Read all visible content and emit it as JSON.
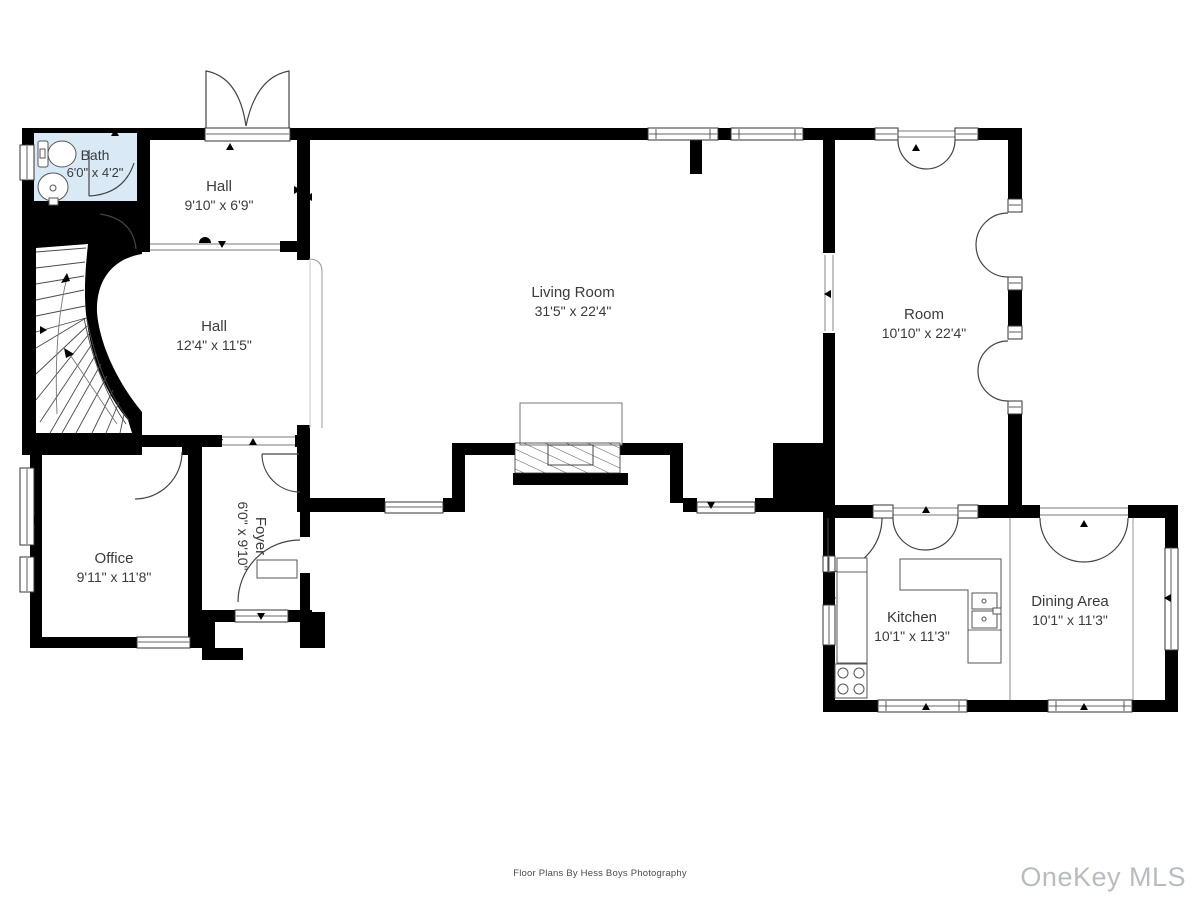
{
  "plan": {
    "credit": "Floor Plans By Hess Boys Photography",
    "watermark": "OneKey MLS",
    "colors": {
      "wall": "#000000",
      "bath_fill": "#d9eaf6",
      "line": "#4a4a4a",
      "label": "#3b3b3b",
      "watermark": "#b8bcc0"
    },
    "rooms": {
      "bath": {
        "name": "Bath",
        "dims": "6'0\" x 4'2\""
      },
      "hall_upper": {
        "name": "Hall",
        "dims": "9'10\" x 6'9\""
      },
      "hall_lower": {
        "name": "Hall",
        "dims": "12'4\" x 11'5\""
      },
      "living_room": {
        "name": "Living Room",
        "dims": "31'5\" x 22'4\""
      },
      "room": {
        "name": "Room",
        "dims": "10'10\" x 22'4\""
      },
      "office": {
        "name": "Office",
        "dims": "9'11\" x 11'8\""
      },
      "foyer": {
        "name": "Foyer",
        "dims": "6'0\" x 9'10\""
      },
      "kitchen": {
        "name": "Kitchen",
        "dims": "10'1\" x 11'3\""
      },
      "dining": {
        "name": "Dining Area",
        "dims": "10'1\" x 11'3\""
      }
    }
  }
}
